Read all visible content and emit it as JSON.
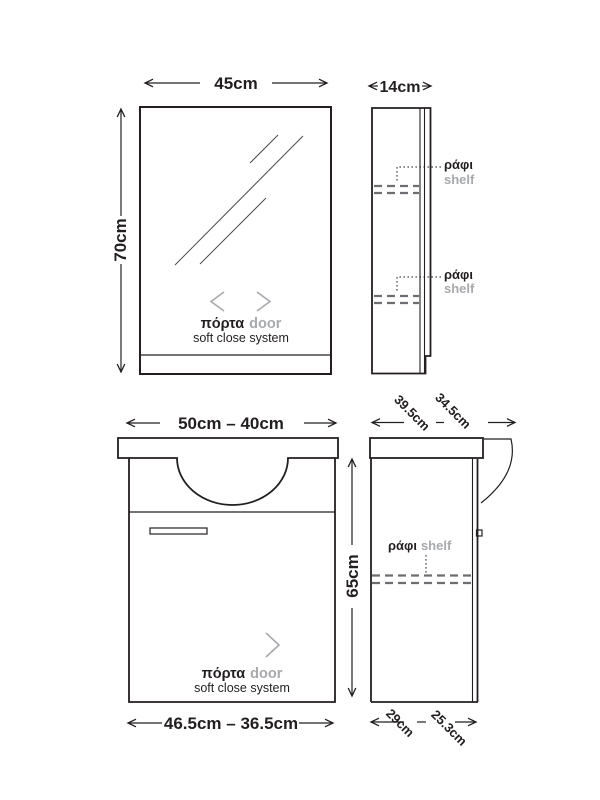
{
  "colors": {
    "ink": "#231f20",
    "muted_gray": "#a7a9ac",
    "shelf_dash": "#6d6e71"
  },
  "views": {
    "mirror_front": {
      "width_label": "45cm",
      "height_label": "70cm",
      "door_gr": "πόρτα",
      "door_en": "door",
      "subtitle": "soft close system"
    },
    "mirror_side": {
      "depth_label": "14cm",
      "shelves": [
        {
          "label_gr": "ράφι",
          "label_en": "shelf"
        },
        {
          "label_gr": "ράφι",
          "label_en": "shelf"
        }
      ]
    },
    "vanity_front": {
      "top_width_label": "50cm – 40cm",
      "height_label": "65cm",
      "bottom_width_label": "46.5cm – 36.5cm",
      "door_gr": "πόρτα",
      "door_en": "door",
      "subtitle": "soft close system"
    },
    "vanity_side": {
      "top_depth_labels": [
        "39.5cm",
        "34.5cm"
      ],
      "top_depth_separator": "–",
      "bottom_depth_labels": [
        "29cm",
        "25.3cm"
      ],
      "bottom_depth_separator": "–",
      "shelf": {
        "label_gr": "ράφι",
        "label_en": "shelf"
      }
    }
  }
}
